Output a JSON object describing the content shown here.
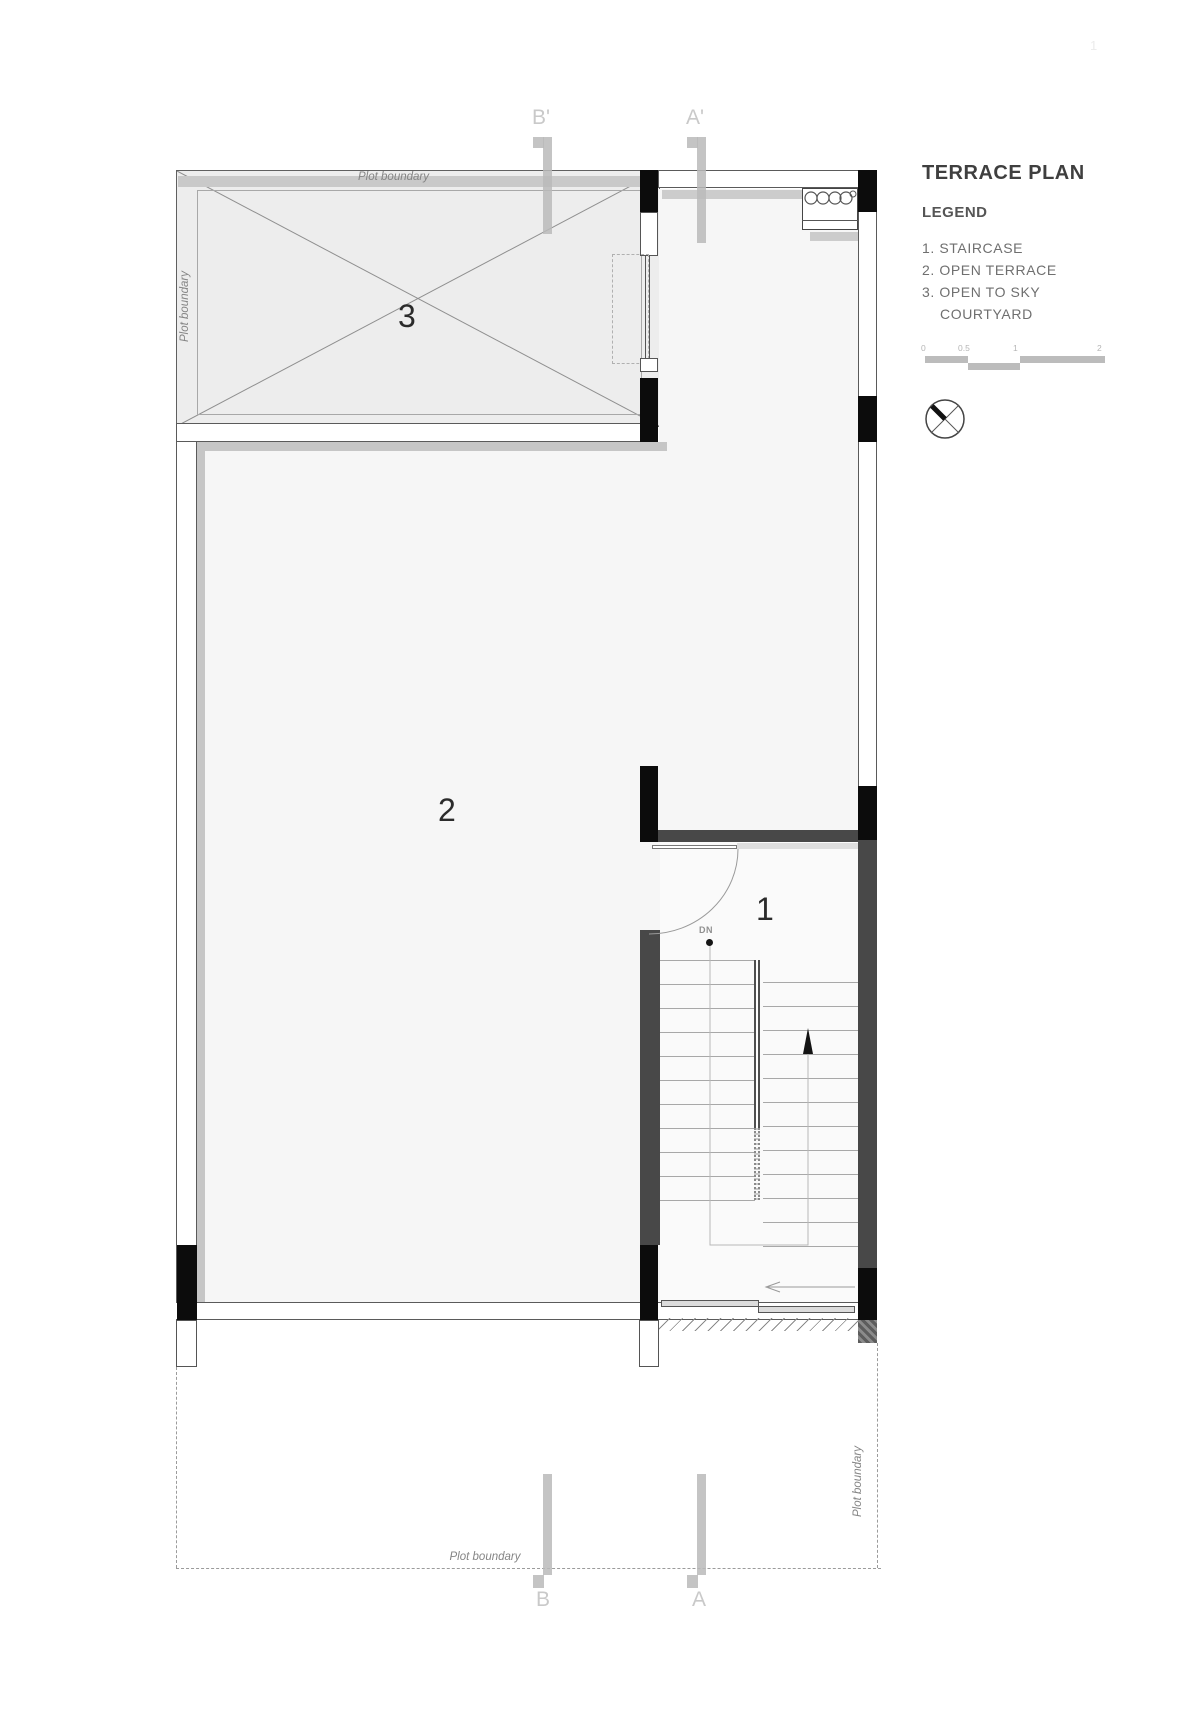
{
  "header": {
    "title": "TERRACE PLAN",
    "legend_heading": "LEGEND",
    "legend_items": [
      "1. STAIRCASE",
      "2. OPEN TERRACE",
      "3. OPEN TO SKY",
      "COURTYARD"
    ],
    "page_mark": "1"
  },
  "scale_bar": {
    "ticks": [
      "0",
      "0.5",
      "1",
      "2"
    ]
  },
  "plan": {
    "plot_boundary_label": "Plot boundary",
    "room_labels": {
      "staircase": "1",
      "terrace": "2",
      "courtyard": "3"
    },
    "down_label": "DN",
    "sections": {
      "b_top": "B'",
      "a_top": "A'",
      "b_bottom": "B",
      "a_bottom": "A"
    }
  },
  "colors": {
    "column_black": "#0c0c0c",
    "stair_wall_gray": "#484848",
    "parapet_gray": "#c6c6c6",
    "floor_tint": "#f6f6f6",
    "courtyard_tint": "#ededed",
    "section_marker_gray": "#c7c7c7"
  },
  "icons": {
    "north_compass": "north-compass-icon",
    "courtyard_cross": "open-to-sky-cross-icon",
    "door_swing": "door-swing-arc-icon",
    "stair_up_arrow": "stair-up-arrow-icon",
    "exit_arrow": "left-arrow-icon"
  }
}
